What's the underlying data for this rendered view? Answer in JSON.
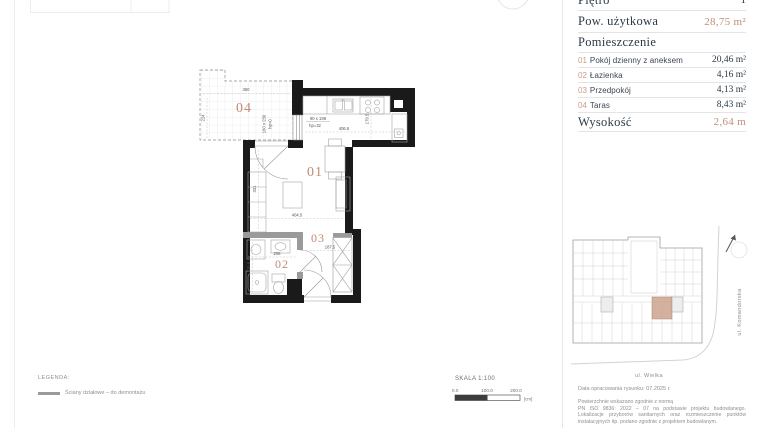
{
  "panel": {
    "floor_label": "Piętro",
    "floor_value": "1",
    "area_label": "Pow. użytkowa",
    "area_value": "28,75 m²",
    "rooms_header": "Pomieszczenie",
    "rooms": [
      {
        "no": "01",
        "name": "Pokój dzienny z aneksem",
        "area": "20,46 m²"
      },
      {
        "no": "02",
        "name": "Łazienka",
        "area": "4,16 m²"
      },
      {
        "no": "03",
        "name": "Przedpokój",
        "area": "4,13 m²"
      },
      {
        "no": "04",
        "name": "Taras",
        "area": "8,43 m²"
      }
    ],
    "height_label": "Wysokość",
    "height_value": "2,64 m"
  },
  "plan": {
    "labels": {
      "living": "01",
      "bath": "02",
      "hall": "03",
      "terrace": "04"
    },
    "dims": {
      "terrace_w": "360",
      "terrace_d": "224",
      "terrace_door": "160 x 230",
      "terrace_door_hp": "hp=0",
      "window": "90 x 198",
      "window_hp": "hp=32",
      "kitchen_w": "406.5",
      "kitchen_d": "179.5",
      "living_w": "404.5",
      "living_d": "331",
      "bath_w": "208",
      "bath_d": "216.5",
      "hall_w": "187.5"
    }
  },
  "siteplan": {
    "street_bottom": "ul. Wielka",
    "street_right": "ul. Komandorska"
  },
  "scale": {
    "title": "SKALA 1:100",
    "t0": "0.0",
    "t1": "100.0",
    "t2": "200.0",
    "unit": "[cm]"
  },
  "legend": {
    "title": "LEGENDA:",
    "item": "Ściany działowe – do demontażu"
  },
  "footer": {
    "date": "Data opracowania rysunku: 07.2025 r.",
    "note_intro": "Powierzchnie wskazano zgodnie z normą",
    "note_body": "PN ISO 9836: 2022 – 07 na podstawie projektu budowlanego. Lokalizacje przyborów sanitarnych oraz rozmieszczenie punktów instalacyjnych itp. podano zgodnie z projektem budowlanym."
  },
  "colors": {
    "accent": "#C18E79",
    "dark_text": "#2B3A47",
    "wall": "#1A1A1A",
    "partition_gray": "#9A9A9A",
    "unit_highlight": "#CDA28D"
  }
}
